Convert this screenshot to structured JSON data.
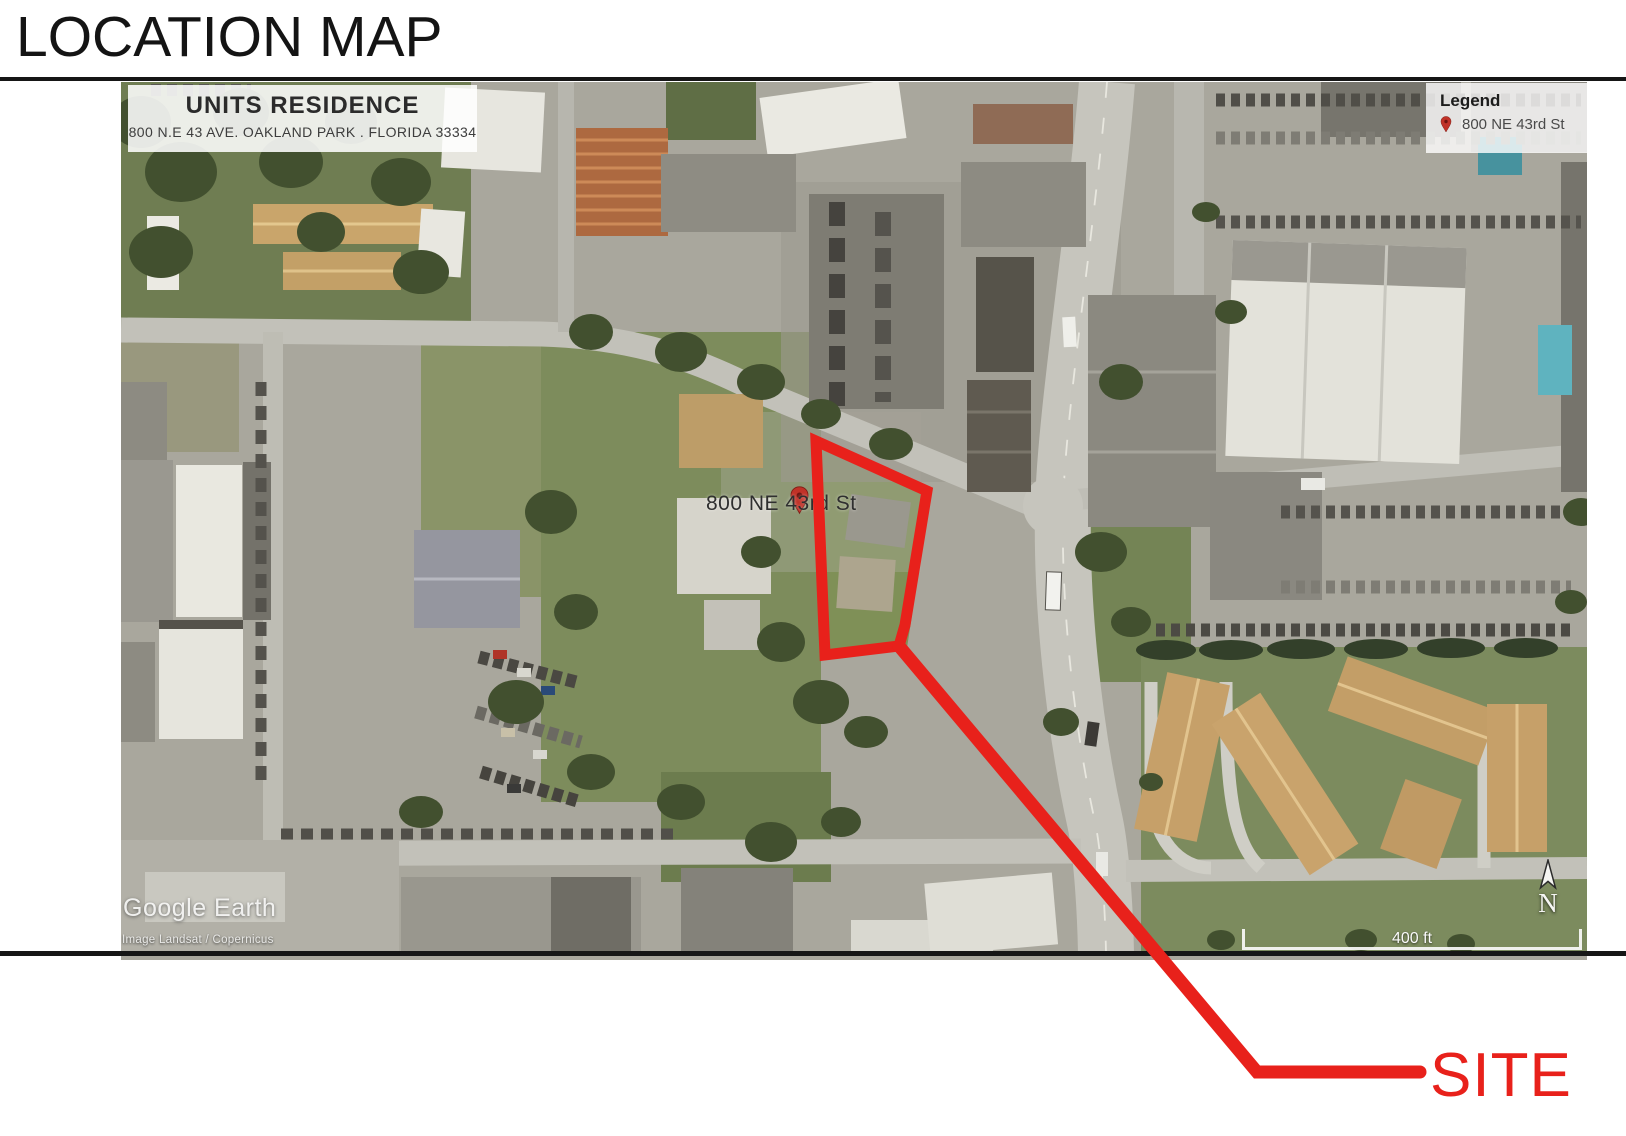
{
  "page": {
    "title": "LOCATION MAP",
    "site_callout": "SITE"
  },
  "map": {
    "title_block": {
      "title": "UNITS RESIDENCE",
      "address": "800 N.E 43 AVE. OAKLAND PARK . FLORIDA 33334"
    },
    "legend": {
      "title": "Legend",
      "items": [
        {
          "icon": "map-pin-icon",
          "label": "800 NE 43rd St"
        }
      ]
    },
    "labels": {
      "street": "800 NE 43rd St"
    },
    "watermark": {
      "brand": "Google Earth",
      "attribution": "Image Landsat / Copernicus"
    },
    "scale_bar": {
      "label": "400 ft"
    },
    "compass": {
      "label": "N"
    }
  },
  "colors": {
    "site_red": "#e8211b",
    "pin_red": "#c03228"
  }
}
